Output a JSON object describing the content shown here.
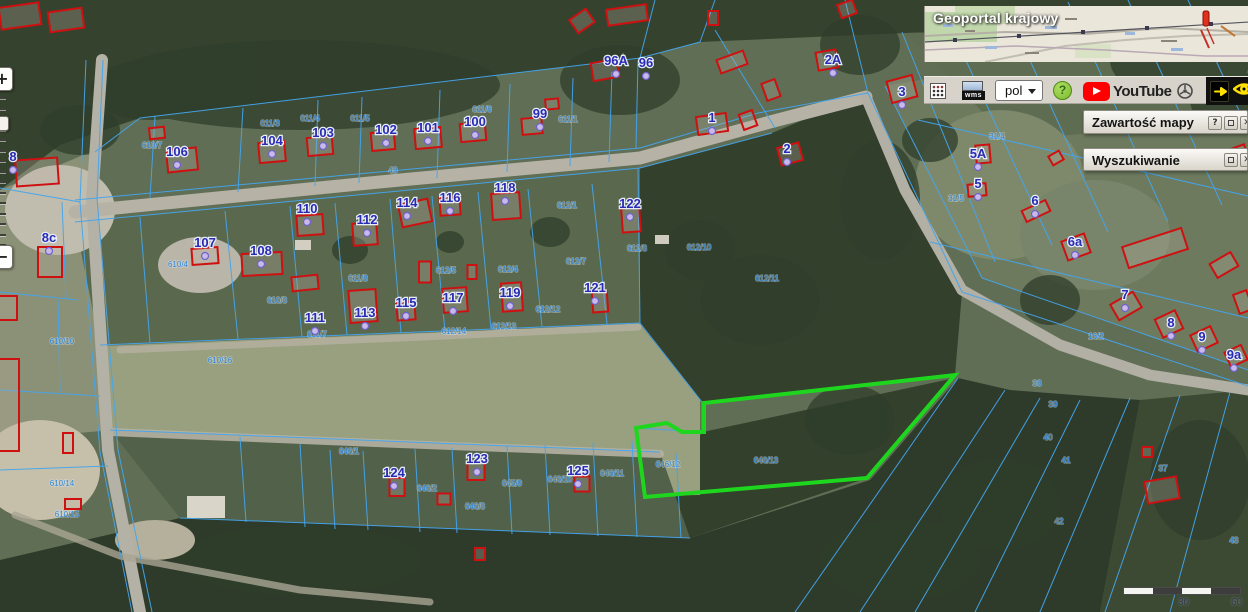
{
  "minimap": {
    "title": "Geoportal krajowy"
  },
  "toolbar": {
    "wms_label": "wms",
    "language_value": "pol",
    "help_label": "?",
    "youtube_label": "YouTube"
  },
  "panels": {
    "map_content": {
      "title": "Zawartość mapy",
      "help": "?",
      "close": "✕"
    },
    "search": {
      "title": "Wyszukiwanie",
      "close": "✕"
    }
  },
  "zoom_control": {
    "zoom_in": "+",
    "zoom_out": "−"
  },
  "scale_bar": {
    "label_mid": "30",
    "label_end": "60"
  },
  "map": {
    "colors": {
      "parcel_line": "#44a5ee",
      "building_outline": "#cf1010",
      "highlight_parcel": "#1fd61f",
      "house_label": "#2a2ab2",
      "parcel_label": "#2f86d8"
    },
    "house_labels": [
      {
        "t": "8",
        "x": 13,
        "y": 157
      },
      {
        "t": "8c",
        "x": 49,
        "y": 238
      },
      {
        "t": "106",
        "x": 177,
        "y": 152
      },
      {
        "t": "107",
        "x": 205,
        "y": 243
      },
      {
        "t": "108",
        "x": 261,
        "y": 251
      },
      {
        "t": "104",
        "x": 272,
        "y": 141
      },
      {
        "t": "103",
        "x": 323,
        "y": 133
      },
      {
        "t": "102",
        "x": 386,
        "y": 130
      },
      {
        "t": "101",
        "x": 428,
        "y": 128
      },
      {
        "t": "100",
        "x": 475,
        "y": 122
      },
      {
        "t": "99",
        "x": 540,
        "y": 114
      },
      {
        "t": "96A",
        "x": 616,
        "y": 61
      },
      {
        "t": "96",
        "x": 646,
        "y": 63
      },
      {
        "t": "110",
        "x": 307,
        "y": 209
      },
      {
        "t": "112",
        "x": 367,
        "y": 220
      },
      {
        "t": "114",
        "x": 407,
        "y": 203
      },
      {
        "t": "116",
        "x": 450,
        "y": 198
      },
      {
        "t": "118",
        "x": 505,
        "y": 188
      },
      {
        "t": "122",
        "x": 630,
        "y": 204
      },
      {
        "t": "111",
        "x": 315,
        "y": 318
      },
      {
        "t": "113",
        "x": 365,
        "y": 313
      },
      {
        "t": "115",
        "x": 406,
        "y": 303
      },
      {
        "t": "117",
        "x": 453,
        "y": 298
      },
      {
        "t": "119",
        "x": 510,
        "y": 293
      },
      {
        "t": "121",
        "x": 595,
        "y": 288
      },
      {
        "t": "124",
        "x": 394,
        "y": 473
      },
      {
        "t": "123",
        "x": 477,
        "y": 459
      },
      {
        "t": "125",
        "x": 578,
        "y": 471
      },
      {
        "t": "1",
        "x": 712,
        "y": 118
      },
      {
        "t": "2",
        "x": 787,
        "y": 149
      },
      {
        "t": "2A",
        "x": 833,
        "y": 60
      },
      {
        "t": "3",
        "x": 902,
        "y": 92
      },
      {
        "t": "5A",
        "x": 978,
        "y": 154
      },
      {
        "t": "5",
        "x": 978,
        "y": 184
      },
      {
        "t": "6",
        "x": 1035,
        "y": 201
      },
      {
        "t": "6a",
        "x": 1075,
        "y": 242
      },
      {
        "t": "7",
        "x": 1125,
        "y": 295
      },
      {
        "t": "8",
        "x": 1171,
        "y": 323
      },
      {
        "t": "9",
        "x": 1202,
        "y": 337
      },
      {
        "t": "9a",
        "x": 1234,
        "y": 355
      }
    ],
    "parcel_labels": [
      {
        "t": "48",
        "x": 393,
        "y": 173
      },
      {
        "t": "611/1",
        "x": 568,
        "y": 122
      },
      {
        "t": "611/3",
        "x": 270,
        "y": 126
      },
      {
        "t": "611/4",
        "x": 310,
        "y": 121
      },
      {
        "t": "611/5",
        "x": 360,
        "y": 121
      },
      {
        "t": "611/6",
        "x": 482,
        "y": 112
      },
      {
        "t": "610/7",
        "x": 152,
        "y": 148
      },
      {
        "t": "610/4",
        "x": 178,
        "y": 267
      },
      {
        "t": "610/8",
        "x": 277,
        "y": 303
      },
      {
        "t": "610/16",
        "x": 220,
        "y": 363
      },
      {
        "t": "610/10",
        "x": 62,
        "y": 344
      },
      {
        "t": "610/14",
        "x": 62,
        "y": 486
      },
      {
        "t": "610/15",
        "x": 67,
        "y": 517
      },
      {
        "t": "611/7",
        "x": 317,
        "y": 337
      },
      {
        "t": "611/8",
        "x": 358,
        "y": 281
      },
      {
        "t": "612/1",
        "x": 567,
        "y": 208
      },
      {
        "t": "612/4",
        "x": 508,
        "y": 272
      },
      {
        "t": "612/5",
        "x": 446,
        "y": 273
      },
      {
        "t": "612/7",
        "x": 576,
        "y": 264
      },
      {
        "t": "612/8",
        "x": 637,
        "y": 251
      },
      {
        "t": "612/10",
        "x": 699,
        "y": 250
      },
      {
        "t": "612/11",
        "x": 767,
        "y": 281
      },
      {
        "t": "612/12",
        "x": 548,
        "y": 312
      },
      {
        "t": "612/13",
        "x": 504,
        "y": 329
      },
      {
        "t": "612/14",
        "x": 454,
        "y": 334
      },
      {
        "t": "646/1",
        "x": 349,
        "y": 454
      },
      {
        "t": "646/2",
        "x": 427,
        "y": 491
      },
      {
        "t": "646/8",
        "x": 475,
        "y": 509
      },
      {
        "t": "645/9",
        "x": 512,
        "y": 486
      },
      {
        "t": "646/10",
        "x": 560,
        "y": 482
      },
      {
        "t": "646/11",
        "x": 612,
        "y": 476
      },
      {
        "t": "646/12",
        "x": 668,
        "y": 467
      },
      {
        "t": "646/13",
        "x": 766,
        "y": 463
      },
      {
        "t": "31/4",
        "x": 997,
        "y": 139
      },
      {
        "t": "31/5",
        "x": 956,
        "y": 201
      },
      {
        "t": "16/2",
        "x": 1096,
        "y": 339
      },
      {
        "t": "38",
        "x": 1037,
        "y": 386
      },
      {
        "t": "39",
        "x": 1053,
        "y": 407
      },
      {
        "t": "40",
        "x": 1048,
        "y": 440
      },
      {
        "t": "41",
        "x": 1066,
        "y": 463
      },
      {
        "t": "42",
        "x": 1059,
        "y": 524
      },
      {
        "t": "37",
        "x": 1163,
        "y": 471
      },
      {
        "t": "43",
        "x": 1234,
        "y": 543
      }
    ],
    "blue_lines": [
      [
        75,
        200,
        640,
        148
      ],
      [
        640,
        148,
        758,
        113
      ],
      [
        758,
        113,
        868,
        93
      ],
      [
        75,
        222,
        640,
        168
      ],
      [
        640,
        168,
        772,
        133
      ],
      [
        868,
        93,
        962,
        292
      ],
      [
        962,
        292,
        1248,
        386
      ],
      [
        885,
        86,
        982,
        278
      ],
      [
        982,
        278,
        1248,
        370
      ],
      [
        140,
        118,
        640,
        58
      ],
      [
        140,
        118,
        95,
        152
      ],
      [
        155,
        116,
        150,
        198
      ],
      [
        243,
        108,
        238,
        192
      ],
      [
        318,
        100,
        315,
        186
      ],
      [
        362,
        97,
        359,
        183
      ],
      [
        440,
        90,
        437,
        178
      ],
      [
        510,
        84,
        507,
        172
      ],
      [
        573,
        78,
        570,
        166
      ],
      [
        612,
        72,
        609,
        162
      ],
      [
        638,
        60,
        636,
        148
      ],
      [
        640,
        58,
        655,
        0
      ],
      [
        700,
        42,
        715,
        0
      ],
      [
        868,
        93,
        845,
        0
      ],
      [
        715,
        30,
        775,
        128
      ],
      [
        700,
        42,
        640,
        58
      ],
      [
        103,
        60,
        97,
        198
      ],
      [
        97,
        198,
        118,
        450
      ],
      [
        118,
        450,
        152,
        612
      ],
      [
        86,
        60,
        80,
        202
      ],
      [
        80,
        202,
        100,
        452
      ],
      [
        100,
        452,
        132,
        612
      ],
      [
        100,
        345,
        640,
        323
      ],
      [
        140,
        217,
        150,
        343
      ],
      [
        225,
        211,
        238,
        339
      ],
      [
        290,
        206,
        302,
        337
      ],
      [
        335,
        203,
        347,
        335
      ],
      [
        390,
        199,
        401,
        333
      ],
      [
        432,
        196,
        445,
        331
      ],
      [
        478,
        192,
        491,
        329
      ],
      [
        528,
        189,
        542,
        327
      ],
      [
        592,
        184,
        607,
        324
      ],
      [
        638,
        168,
        640,
        323
      ],
      [
        640,
        323,
        702,
        402
      ],
      [
        702,
        402,
        702,
        432
      ],
      [
        636,
        428,
        702,
        432
      ],
      [
        110,
        430,
        660,
        452
      ],
      [
        180,
        518,
        690,
        538
      ],
      [
        240,
        437,
        246,
        522
      ],
      [
        300,
        444,
        305,
        527
      ],
      [
        330,
        450,
        335,
        529
      ],
      [
        363,
        451,
        368,
        530
      ],
      [
        415,
        449,
        420,
        532
      ],
      [
        452,
        448,
        457,
        533
      ],
      [
        507,
        446,
        512,
        534
      ],
      [
        545,
        445,
        550,
        535
      ],
      [
        593,
        443,
        598,
        536
      ],
      [
        632,
        441,
        637,
        537
      ],
      [
        676,
        453,
        681,
        538
      ],
      [
        958,
        378,
        795,
        612
      ],
      [
        1005,
        390,
        860,
        612
      ],
      [
        1040,
        398,
        915,
        612
      ],
      [
        1080,
        400,
        975,
        612
      ],
      [
        1130,
        398,
        1040,
        612
      ],
      [
        1180,
        395,
        1105,
        612
      ],
      [
        1230,
        392,
        1170,
        612
      ],
      [
        902,
        32,
        995,
        262
      ],
      [
        948,
        22,
        1052,
        245
      ],
      [
        1008,
        12,
        1108,
        232
      ],
      [
        1068,
        2,
        1168,
        222
      ],
      [
        1128,
        0,
        1222,
        205
      ],
      [
        1188,
        0,
        1248,
        130
      ],
      [
        918,
        120,
        1248,
        196
      ],
      [
        930,
        242,
        1248,
        318
      ],
      [
        0,
        188,
        80,
        202
      ],
      [
        0,
        292,
        78,
        300
      ],
      [
        62,
        202,
        66,
        298
      ],
      [
        0,
        390,
        100,
        396
      ],
      [
        0,
        470,
        108,
        466
      ],
      [
        58,
        300,
        60,
        392
      ]
    ],
    "red_buildings": [
      [
        20,
        16,
        40,
        22,
        -8
      ],
      [
        66,
        20,
        34,
        20,
        -8
      ],
      [
        37,
        172,
        42,
        26,
        -4
      ],
      [
        8,
        308,
        18,
        24,
        0
      ],
      [
        8,
        405,
        22,
        92,
        0
      ],
      [
        68,
        443,
        10,
        20,
        0
      ],
      [
        73,
        504,
        16,
        10,
        0
      ],
      [
        50,
        262,
        24,
        30,
        0
      ],
      [
        157,
        133,
        15,
        11,
        -6
      ],
      [
        182,
        160,
        30,
        22,
        -6
      ],
      [
        205,
        256,
        26,
        16,
        -4
      ],
      [
        262,
        264,
        40,
        22,
        -3
      ],
      [
        305,
        283,
        26,
        14,
        -6
      ],
      [
        272,
        152,
        26,
        20,
        -5
      ],
      [
        320,
        146,
        25,
        18,
        -5
      ],
      [
        383,
        141,
        23,
        18,
        -5
      ],
      [
        428,
        138,
        26,
        20,
        -5
      ],
      [
        473,
        132,
        25,
        18,
        -5
      ],
      [
        532,
        126,
        20,
        16,
        -5
      ],
      [
        552,
        104,
        13,
        10,
        -5
      ],
      [
        605,
        70,
        26,
        18,
        -10
      ],
      [
        627,
        15,
        40,
        16,
        -8
      ],
      [
        582,
        21,
        20,
        16,
        -35
      ],
      [
        713,
        18,
        10,
        14,
        0
      ],
      [
        310,
        225,
        26,
        20,
        -4
      ],
      [
        365,
        234,
        24,
        22,
        -4
      ],
      [
        415,
        213,
        30,
        23,
        -12
      ],
      [
        450,
        206,
        20,
        18,
        -4
      ],
      [
        506,
        206,
        28,
        26,
        -4
      ],
      [
        631,
        220,
        18,
        24,
        -4
      ],
      [
        363,
        306,
        27,
        32,
        -4
      ],
      [
        406,
        311,
        18,
        18,
        -4
      ],
      [
        425,
        272,
        12,
        21,
        0
      ],
      [
        455,
        300,
        24,
        24,
        -4
      ],
      [
        472,
        272,
        9,
        14,
        0
      ],
      [
        512,
        297,
        20,
        28,
        -4
      ],
      [
        600,
        302,
        15,
        20,
        -4
      ],
      [
        712,
        124,
        30,
        18,
        -8
      ],
      [
        732,
        62,
        28,
        14,
        -20
      ],
      [
        790,
        154,
        22,
        18,
        -15
      ],
      [
        771,
        90,
        14,
        18,
        -20
      ],
      [
        748,
        120,
        14,
        16,
        -20
      ],
      [
        827,
        60,
        20,
        18,
        -10
      ],
      [
        847,
        9,
        16,
        14,
        -20
      ],
      [
        902,
        89,
        26,
        22,
        -15
      ],
      [
        983,
        154,
        14,
        18,
        -5
      ],
      [
        977,
        190,
        18,
        12,
        -5
      ],
      [
        1036,
        211,
        26,
        12,
        -25
      ],
      [
        1056,
        158,
        12,
        10,
        -30
      ],
      [
        1076,
        247,
        24,
        20,
        -20
      ],
      [
        1155,
        248,
        62,
        22,
        -18
      ],
      [
        1224,
        265,
        24,
        16,
        -30
      ],
      [
        1243,
        302,
        14,
        20,
        -20
      ],
      [
        1235,
        155,
        24,
        14,
        -20
      ],
      [
        1126,
        306,
        26,
        18,
        -30
      ],
      [
        1169,
        324,
        22,
        20,
        -25
      ],
      [
        1204,
        339,
        22,
        18,
        -25
      ],
      [
        1236,
        356,
        18,
        16,
        -25
      ],
      [
        397,
        487,
        15,
        18,
        0
      ],
      [
        444,
        499,
        13,
        11,
        0
      ],
      [
        476,
        471,
        17,
        18,
        0
      ],
      [
        582,
        484,
        15,
        15,
        0
      ],
      [
        480,
        554,
        10,
        12,
        0
      ],
      [
        1147,
        452,
        10,
        10,
        0
      ],
      [
        1162,
        490,
        32,
        22,
        -10
      ]
    ],
    "green_parcel": [
      [
        636,
        428
      ],
      [
        667,
        423
      ],
      [
        682,
        432
      ],
      [
        704,
        432
      ],
      [
        704,
        403
      ],
      [
        955,
        375
      ],
      [
        867,
        478
      ],
      [
        645,
        497
      ]
    ]
  }
}
